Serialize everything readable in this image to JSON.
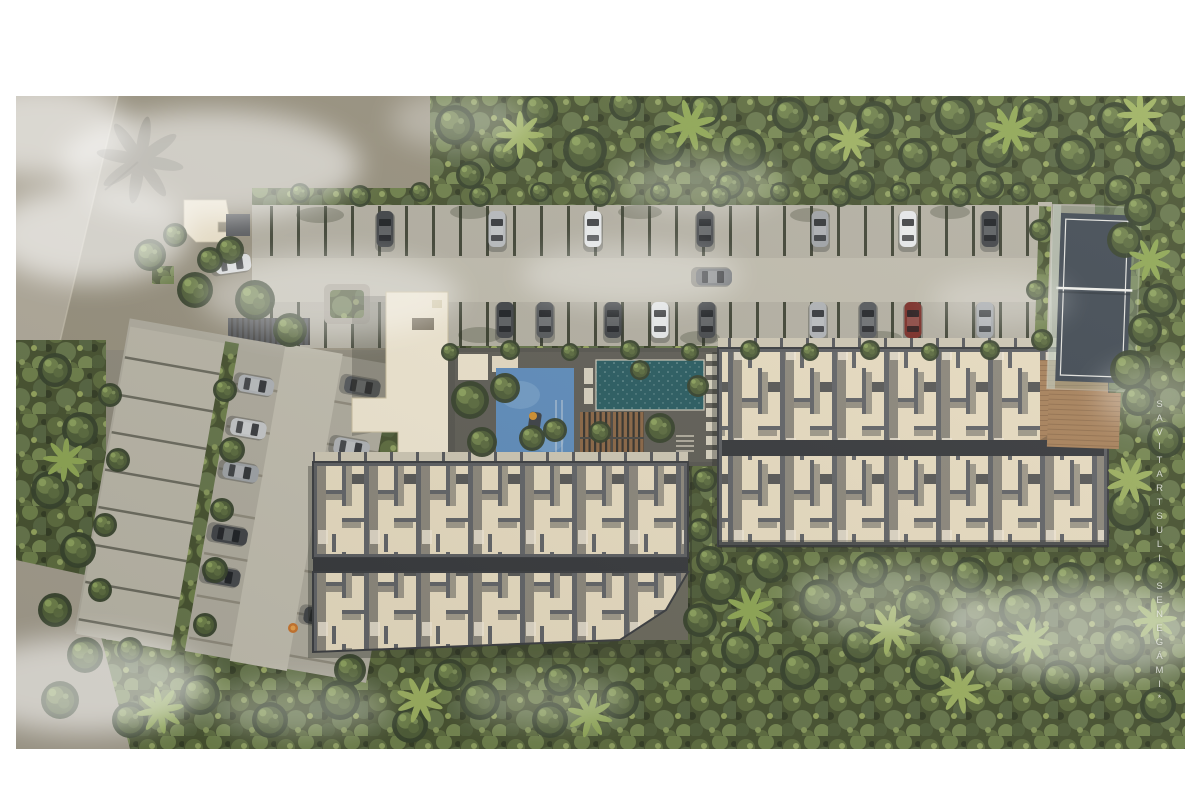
{
  "watermark": {
    "text": "*IMÁGENES ILUSTRATIVAS"
  },
  "palette": {
    "background": "#ffffff",
    "jungle_base": "#45502e",
    "entry_pavement": "#98917f",
    "road": "#b2ab9c",
    "parking_slab": "#b4b0a3",
    "parking_lane": "#c0bcae",
    "building_wall": "#5a5c60",
    "unit_floor": "#e9ddc2",
    "corridor": "#34363a",
    "tower_roof": "#f1e8d3",
    "guardhouse_roof": "#eee4cd",
    "pool_teal": "#265a60",
    "pool_blue": "#5d8cbd",
    "wood_deck": "#a8815a",
    "padel_court": "#3f4852",
    "car_red": "#7a2a24",
    "mist": "#ffffff"
  }
}
